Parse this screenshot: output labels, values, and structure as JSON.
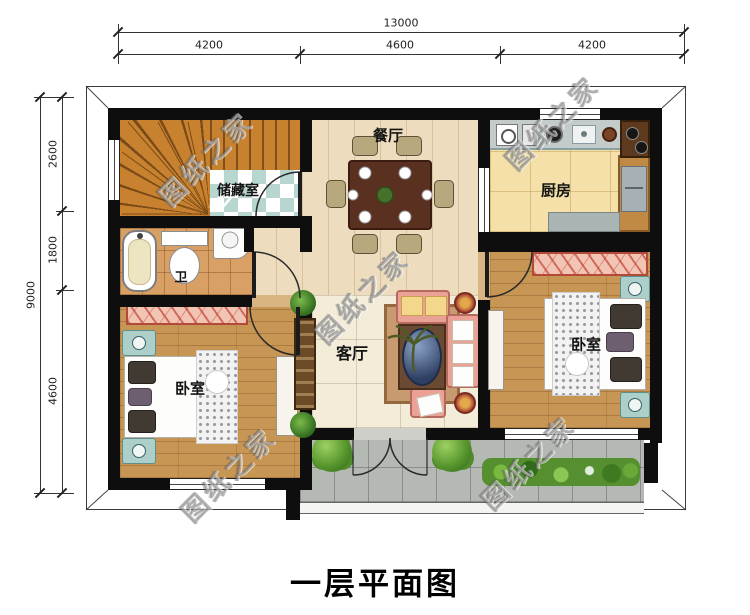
{
  "title": "一层平面图",
  "watermark_text": "图纸之家",
  "dimensions": {
    "top": {
      "total": "13000",
      "segments": [
        "4200",
        "4600",
        "4200"
      ]
    },
    "left": {
      "total": "9000",
      "segments": [
        "2600",
        "1800",
        "4600"
      ]
    }
  },
  "rooms": {
    "dining": "餐厅",
    "kitchen": "厨房",
    "storage": "储藏室",
    "bath": "卫",
    "living": "客厅",
    "bedroom_left": "卧室",
    "bedroom_right": "卧室"
  },
  "colors": {
    "wall": "#0e0e0e",
    "dining_floor": "#eddcbe",
    "living_floor": "#f3ecd9",
    "kitchen_floor": "#f4e0a8",
    "bath_floor": "#d9a066",
    "bedroom_floor": "#c79654",
    "porch_floor": "#b5b9b3",
    "storage_checker": "#b6d6cf",
    "stair_wood": "#c7812f",
    "wardrobe_hatch": "#f2c4b4",
    "sofa": "#e9a295",
    "nightstand_teal": "#accfc9"
  }
}
